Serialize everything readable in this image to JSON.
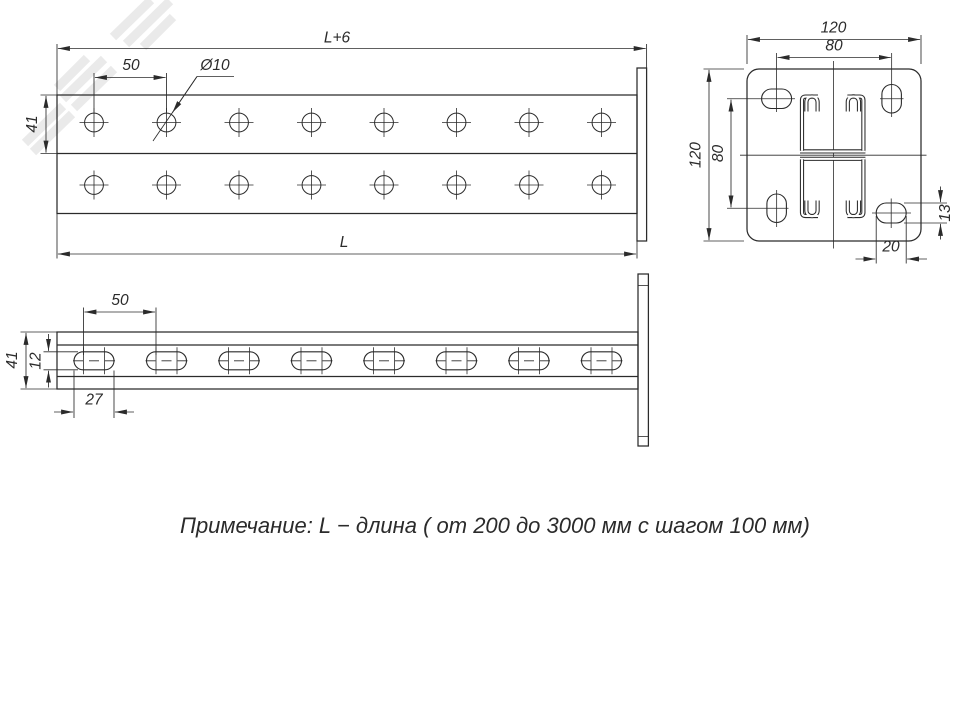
{
  "note": {
    "text": "Примечание: L − длина ( от 200 до 3000 мм с шагом 100 мм)"
  },
  "dimensions": {
    "front": {
      "overall_length": "L+6",
      "hole_pitch": "50",
      "hole_diameter": "Ø10",
      "flange_width": "41",
      "length": "L"
    },
    "side": {
      "slot_pitch": "50",
      "height": "41",
      "slot_width": "12",
      "slot_length": "27"
    },
    "end": {
      "plate_width": "120",
      "hole_spacing_horizontal": "80",
      "plate_height": "120",
      "hole_spacing_vertical": "80",
      "slot_height": "13",
      "slot_width": "20"
    }
  },
  "colors": {
    "line": "#2b2b2b",
    "background": "#ffffff",
    "watermark": "#e8e8e8"
  }
}
